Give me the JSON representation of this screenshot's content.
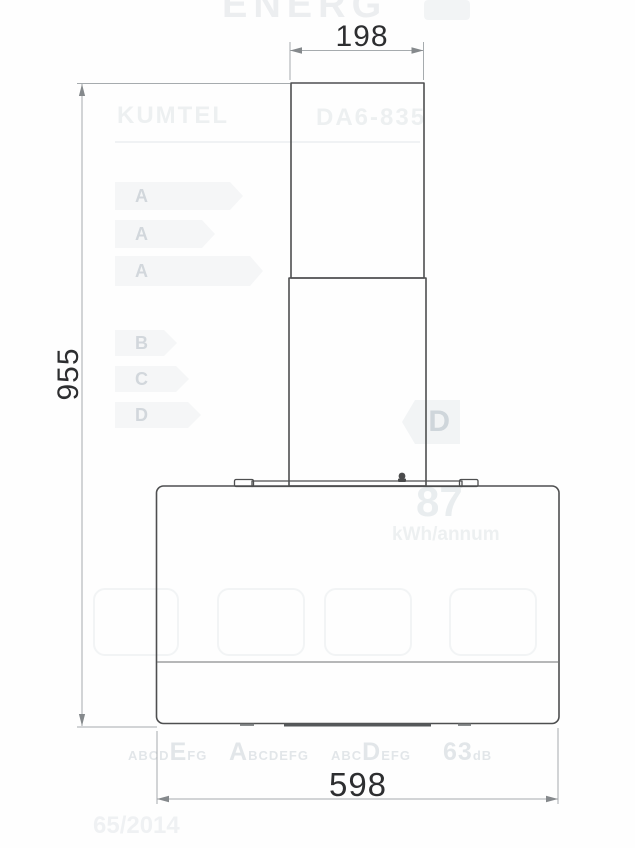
{
  "drawing": {
    "dim_chimney_width": "198",
    "dim_total_height": "955",
    "dim_body_width": "598"
  },
  "watermark": {
    "energy_word": "ENERG",
    "brand": "KUMTEL",
    "model": "DA6-835",
    "class_bars": [
      "A",
      "A",
      "A",
      "B",
      "C",
      "D"
    ],
    "class_arrow_letter": "D",
    "annual_consumption": "87",
    "consumption_unit": "kWh/annum",
    "fan_class": {
      "pre": "ABCD",
      "big": "E",
      "post": "FG"
    },
    "lighting_class": {
      "pre": "",
      "big": "A",
      "post": "BCDEFG"
    },
    "grease_class": {
      "pre": "ABC",
      "big": "D",
      "post": "EFG"
    },
    "noise": {
      "pre": "",
      "big": "63",
      "post": "dB"
    },
    "regulation": "65/2014"
  }
}
